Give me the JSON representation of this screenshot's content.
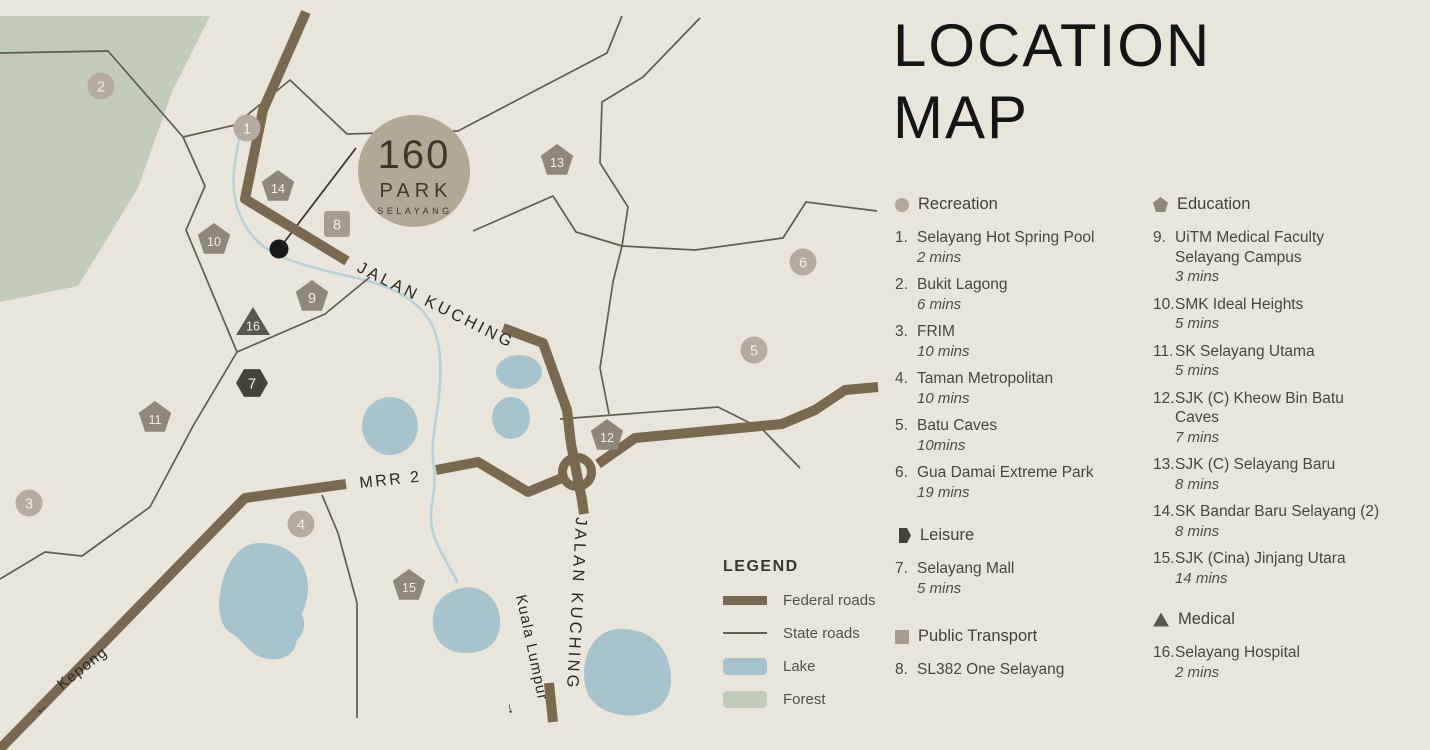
{
  "title": {
    "line1": "LOCATION",
    "line2": "MAP"
  },
  "logo": {
    "number": "160",
    "name": "PARK",
    "sub": "SELAYANG"
  },
  "map": {
    "road_labels": {
      "jalan_kuching_diag": "JALAN KUCHING",
      "jalan_kuching_vert": "JALAN KUCHING",
      "mrr2": "MRR 2",
      "kepong": "Kepong",
      "kepong_arrow": "←",
      "kuala_lumpur": "Kuala Lumpur",
      "kuala_lumpur_arrow": "→"
    },
    "marker_colors": {
      "circle": "#b5aba0",
      "pentagon": "#8e887a",
      "square": "#a49d8f",
      "hexagon": "#45423a",
      "triangle": "#5b574e"
    },
    "palette": {
      "background": "#e9e5da",
      "federal_road": "#7a6850",
      "state_road": "#615d4f",
      "lake": "#a7c3ce",
      "river": "#b7d1d8",
      "forest": "#c3ccbb",
      "logo_badge": "#b1a995",
      "site_dot": "#1a1a1a"
    },
    "markers": [
      {
        "num": "1",
        "type": "circle",
        "x": 247,
        "y": 128
      },
      {
        "num": "2",
        "type": "circle",
        "x": 101,
        "y": 86
      },
      {
        "num": "3",
        "type": "circle",
        "x": 29,
        "y": 503
      },
      {
        "num": "4",
        "type": "circle",
        "x": 301,
        "y": 524
      },
      {
        "num": "5",
        "type": "circle",
        "x": 754,
        "y": 350
      },
      {
        "num": "6",
        "type": "circle",
        "x": 803,
        "y": 262
      },
      {
        "num": "7",
        "type": "hexagon",
        "x": 252,
        "y": 383
      },
      {
        "num": "8",
        "type": "square",
        "x": 337,
        "y": 224
      },
      {
        "num": "9",
        "type": "pentagon",
        "x": 312,
        "y": 297
      },
      {
        "num": "10",
        "type": "pentagon",
        "x": 214,
        "y": 240
      },
      {
        "num": "11",
        "type": "pentagon",
        "x": 155,
        "y": 418
      },
      {
        "num": "12",
        "type": "pentagon",
        "x": 607,
        "y": 436
      },
      {
        "num": "13",
        "type": "pentagon",
        "x": 557,
        "y": 161
      },
      {
        "num": "14",
        "type": "pentagon",
        "x": 278,
        "y": 187
      },
      {
        "num": "15",
        "type": "pentagon",
        "x": 409,
        "y": 586
      },
      {
        "num": "16",
        "type": "triangle",
        "x": 253,
        "y": 321
      }
    ]
  },
  "legend": {
    "title": "LEGEND",
    "items": [
      {
        "type": "federal",
        "label": "Federal roads"
      },
      {
        "type": "state",
        "label": "State roads"
      },
      {
        "type": "lake",
        "label": "Lake"
      },
      {
        "type": "forest",
        "label": "Forest"
      }
    ]
  },
  "sections": [
    {
      "id": "recreation",
      "label": "Recreation",
      "icon": "circle",
      "color": "#b2a89b",
      "column": 1,
      "top": 195,
      "items": [
        {
          "num": "1.",
          "name": "Selayang Hot Spring Pool",
          "time": "2 mins"
        },
        {
          "num": "2.",
          "name": "Bukit Lagong",
          "time": "6 mins"
        },
        {
          "num": "3.",
          "name": "FRIM",
          "time": "10 mins"
        },
        {
          "num": "4.",
          "name": "Taman Metropolitan",
          "time": "10 mins"
        },
        {
          "num": "5.",
          "name": "Batu Caves",
          "time": "10mins"
        },
        {
          "num": "6.",
          "name": "Gua Damai Extreme Park",
          "time": "19 mins"
        }
      ]
    },
    {
      "id": "leisure",
      "label": "Leisure",
      "icon": "hexagon",
      "color": "#45423a",
      "column": 1,
      "top": 526,
      "items": [
        {
          "num": "7.",
          "name": "Selayang Mall",
          "time": "5 mins"
        }
      ]
    },
    {
      "id": "public-transport",
      "label": "Public Transport",
      "icon": "square",
      "color": "#a49d8f",
      "column": 1,
      "top": 627,
      "items": [
        {
          "num": "8.",
          "name": "SL382 One Selayang",
          "time": ""
        }
      ]
    },
    {
      "id": "education",
      "label": "Education",
      "icon": "pentagon",
      "color": "#8e887a",
      "column": 2,
      "top": 195,
      "items": [
        {
          "num": "9.",
          "name": "UiTM Medical Faculty\nSelayang Campus",
          "time": "3 mins"
        },
        {
          "num": "10.",
          "name": "SMK Ideal Heights",
          "time": "5 mins"
        },
        {
          "num": "11.",
          "name": "SK Selayang Utama",
          "time": "5 mins"
        },
        {
          "num": "12.",
          "name": "SJK (C) Kheow Bin Batu\nCaves",
          "time": "7 mins"
        },
        {
          "num": "13.",
          "name": "SJK (C) Selayang Baru",
          "time": "8 mins"
        },
        {
          "num": "14.",
          "name": "SK Bandar Baru Selayang (2)",
          "time": "8 mins"
        },
        {
          "num": "15.",
          "name": "SJK (Cina) Jinjang Utara",
          "time": "14 mins"
        }
      ]
    },
    {
      "id": "medical",
      "label": "Medical",
      "icon": "triangle",
      "color": "#5b574e",
      "column": 2,
      "top": 610,
      "items": [
        {
          "num": "16.",
          "name": "Selayang Hospital",
          "time": "2 mins"
        }
      ]
    }
  ]
}
